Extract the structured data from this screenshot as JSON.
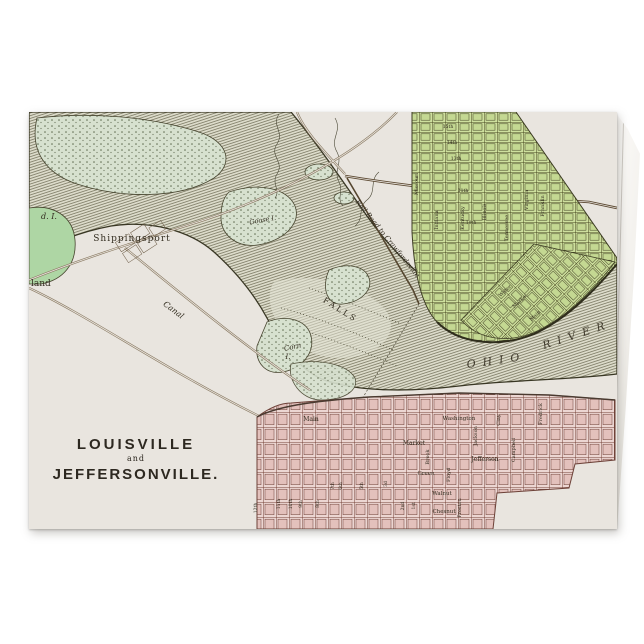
{
  "page": {
    "background": "#ffffff"
  },
  "card": {
    "kind": "folded greeting card mockup",
    "paper_color": "#e9e5df",
    "title_block": {
      "line1": "LOUISVILLE",
      "line2": "and",
      "line3": "JEFFERSONVILLE."
    }
  },
  "map": {
    "subject": "Antique engraved map of Louisville and Jeffersonville at the Falls of the Ohio",
    "colors": {
      "paper": "#e9e5df",
      "label": "#332d20",
      "river_line": "#6e6c55",
      "river_bank": "#383623",
      "island_green": "#d7e1cf",
      "bright_green": "#aed6a4",
      "city_green": "#cee09e",
      "city_green_line": "#45451f",
      "city_pink": "#ecd6d2",
      "city_pink_line": "#744238",
      "road": "#8a7a62"
    },
    "labels": [
      {
        "t": "Shippingsport",
        "x": 103,
        "y": 129,
        "s": 9,
        "sp": 1
      },
      {
        "t": "land",
        "x": 2,
        "y": 174,
        "s": 9,
        "a": "start"
      },
      {
        "t": "d. I.",
        "x": 20,
        "y": 107,
        "s": 8,
        "i": 1
      },
      {
        "t": "Goose I.",
        "x": 234,
        "y": 110,
        "s": 6.5,
        "i": 1,
        "r": -10
      },
      {
        "t": "Corn",
        "x": 264,
        "y": 237,
        "s": 7,
        "i": 1,
        "r": -12
      },
      {
        "t": "I.",
        "x": 259,
        "y": 247,
        "s": 7,
        "i": 1
      },
      {
        "t": "Canal",
        "x": 143,
        "y": 200,
        "s": 8,
        "i": 1,
        "r": 37
      },
      {
        "t": "FALLS",
        "x": 310,
        "y": 200,
        "s": 8,
        "sp": 2.5,
        "r": 32
      },
      {
        "t": "Rail Road to Crawfordsville",
        "x": 357,
        "y": 128,
        "s": 7,
        "i": 1,
        "r": 51
      },
      {
        "t": "OHIO",
        "x": 468,
        "y": 252,
        "s": 11,
        "sp": 7,
        "i": 1,
        "r": -8,
        "o": 0.9
      },
      {
        "t": "RIVER",
        "x": 549,
        "y": 226,
        "s": 11,
        "sp": 7,
        "i": 1,
        "r": -18,
        "o": 0.9
      },
      {
        "t": "Missouri",
        "x": 389,
        "y": 72,
        "s": 5,
        "r": -90
      },
      {
        "t": "Indiana",
        "x": 409,
        "y": 108,
        "s": 5,
        "r": -90
      },
      {
        "t": "Kentucky",
        "x": 435,
        "y": 106,
        "s": 5,
        "r": -90
      },
      {
        "t": "Illinois",
        "x": 457,
        "y": 100,
        "s": 5,
        "r": -90
      },
      {
        "t": "Tennessee",
        "x": 479,
        "y": 116,
        "s": 5,
        "r": -90
      },
      {
        "t": "Virginia",
        "x": 499,
        "y": 88,
        "s": 5,
        "r": -90
      },
      {
        "t": "Franklin",
        "x": 515,
        "y": 94,
        "s": 5,
        "r": -90
      },
      {
        "t": "15th",
        "x": 419,
        "y": 16,
        "s": 4.5
      },
      {
        "t": "14th",
        "x": 423,
        "y": 32,
        "s": 4.5
      },
      {
        "t": "13th",
        "x": 427,
        "y": 48,
        "s": 4.5
      },
      {
        "t": "11th",
        "x": 434,
        "y": 80,
        "s": 4.5
      },
      {
        "t": "10th",
        "x": 442,
        "y": 112,
        "s": 4.5
      },
      {
        "t": "Water",
        "x": 477,
        "y": 180,
        "s": 5,
        "r": -43
      },
      {
        "t": "Market",
        "x": 492,
        "y": 190,
        "s": 5,
        "r": -43
      },
      {
        "t": "Main",
        "x": 507,
        "y": 205,
        "s": 5,
        "r": -43
      },
      {
        "t": "Main",
        "x": 282,
        "y": 309,
        "s": 6
      },
      {
        "t": "Washington",
        "x": 430,
        "y": 308,
        "s": 5.5
      },
      {
        "t": "Market",
        "x": 385,
        "y": 333,
        "s": 6
      },
      {
        "t": "Jefferson",
        "x": 456,
        "y": 349,
        "s": 6
      },
      {
        "t": "Green",
        "x": 397,
        "y": 363,
        "s": 5.5
      },
      {
        "t": "Walnut",
        "x": 413,
        "y": 383,
        "s": 5.5
      },
      {
        "t": "Chesnut",
        "x": 415,
        "y": 401,
        "s": 5.5
      },
      {
        "t": "Brook",
        "x": 400,
        "y": 345,
        "s": 5,
        "r": -90
      },
      {
        "t": "Floyd",
        "x": 421,
        "y": 363,
        "s": 5,
        "r": -90
      },
      {
        "t": "Preston",
        "x": 432,
        "y": 396,
        "s": 5,
        "r": -90
      },
      {
        "t": "Jackson",
        "x": 448,
        "y": 324,
        "s": 5,
        "r": -90
      },
      {
        "t": "Clay",
        "x": 471,
        "y": 308,
        "s": 5,
        "r": -90
      },
      {
        "t": "Campbell",
        "x": 486,
        "y": 338,
        "s": 5,
        "r": -90
      },
      {
        "t": "Fredrick",
        "x": 513,
        "y": 302,
        "s": 5,
        "r": -90
      },
      {
        "t": "12th",
        "x": 228,
        "y": 396,
        "s": 4.5,
        "r": -90
      },
      {
        "t": "11th",
        "x": 251,
        "y": 392,
        "s": 4.5,
        "r": -90
      },
      {
        "t": "10th",
        "x": 263,
        "y": 392,
        "s": 4.5,
        "r": -90
      },
      {
        "t": "9th",
        "x": 273,
        "y": 392,
        "s": 4.5,
        "r": -90
      },
      {
        "t": "8th",
        "x": 290,
        "y": 392,
        "s": 4.5,
        "r": -90
      },
      {
        "t": "7th",
        "x": 305,
        "y": 374,
        "s": 4.5,
        "r": -90
      },
      {
        "t": "6th",
        "x": 313,
        "y": 374,
        "s": 4.5,
        "r": -90
      },
      {
        "t": "5th",
        "x": 334,
        "y": 374,
        "s": 4.5,
        "r": -90
      },
      {
        "t": "3d",
        "x": 358,
        "y": 372,
        "s": 4.5,
        "r": -90
      },
      {
        "t": "2nd",
        "x": 375,
        "y": 394,
        "s": 4.5,
        "r": -90
      },
      {
        "t": "1st",
        "x": 386,
        "y": 394,
        "s": 4.5,
        "r": -90
      }
    ]
  }
}
